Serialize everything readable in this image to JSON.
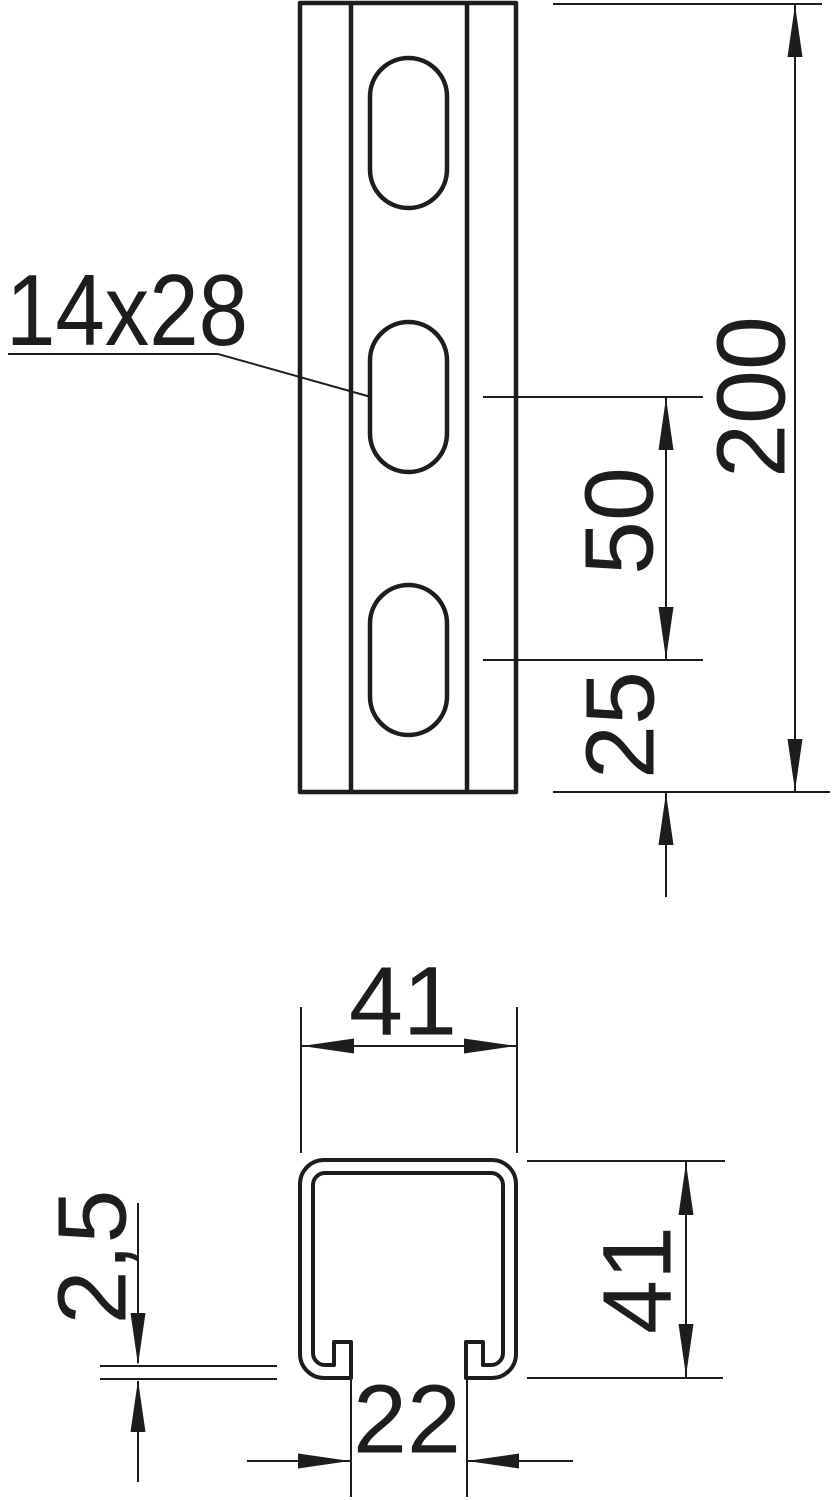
{
  "drawing": {
    "type": "technical-drawing",
    "subject": "slotted mounting rail / strut channel, front view and cross-section",
    "colors": {
      "line": "#1d1d1b",
      "background": "#ffffff"
    },
    "front_view": {
      "slot_label": "14x28",
      "dim_slot_pitch": "50",
      "dim_end_offset": "25",
      "dim_length": "200"
    },
    "section_view": {
      "dim_width": "41",
      "dim_height": "41",
      "dim_thickness": "2,5",
      "dim_opening": "22"
    }
  }
}
